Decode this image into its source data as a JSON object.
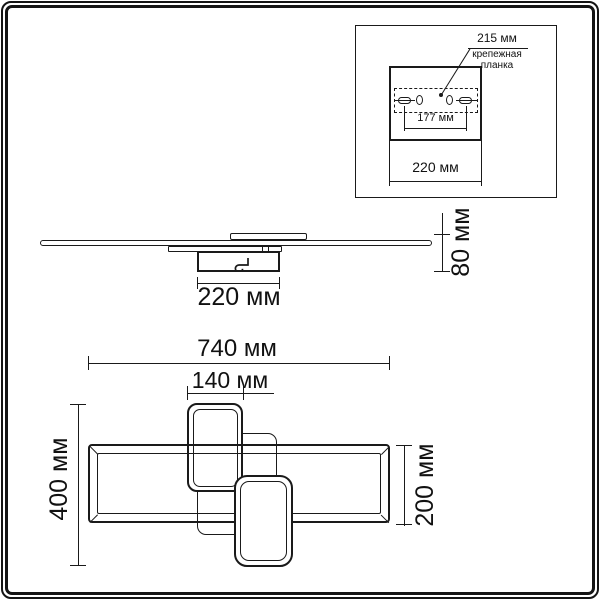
{
  "drawing_type": "ceiling-light-fixture dimensional drawing",
  "language": "ru",
  "colors": {
    "line": "#1a1a1a",
    "background": "#ffffff",
    "text": "#111111"
  },
  "inset": {
    "dim_plate_width": "215 мм",
    "plate_label_line1": "крепежная",
    "plate_label_line2": "планка",
    "dim_holes_distance": "177 мм",
    "dim_canopy_width": "220 мм"
  },
  "side_view": {
    "dim_canopy_width": "220 мм",
    "dim_height": "80 мм"
  },
  "top_view": {
    "dim_total_width": "740 мм",
    "dim_small_frame_width": "140 мм",
    "dim_total_depth": "400 мм",
    "dim_main_frame_depth": "200 мм"
  }
}
